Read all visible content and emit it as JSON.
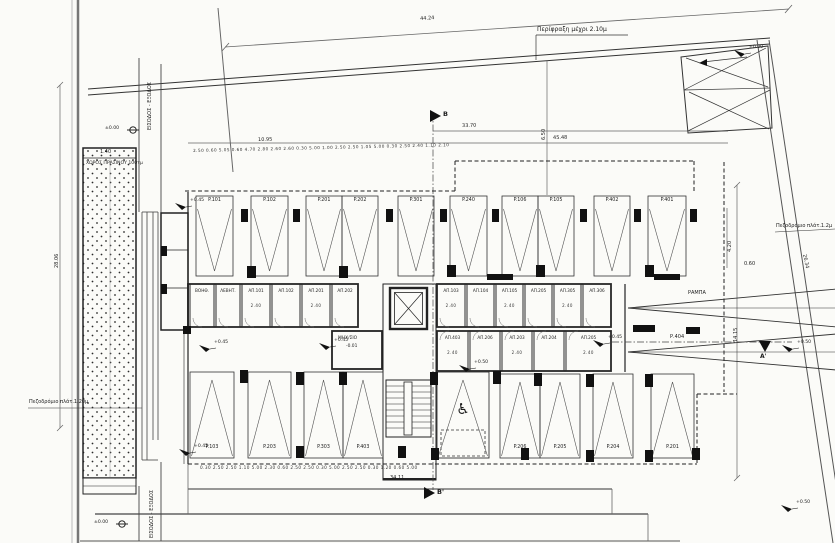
{
  "site": {
    "fence_label": "Περίφραξη μέχρι 2.10μ",
    "sidewalk_right_label": "Πεζοδρόμιο πλάτ.1.2μ",
    "sidewalk_left_label": "Πεζοδρόμιο πλάτ.1.20μ",
    "green_area_label": "ΧΩΡΟΣ ΠΡΑΣΙΝΟΥ 100τμ",
    "entry_top_label": "ΕΙΣΟΔΟΣ - ΕΞΟΔΟΣ",
    "entry_bottom_label": "ΕΙΣΟΔΟΣ - ΕΞΟΔΟΣ",
    "machine_room_label": "ΜΗΧ/ΣΙΟ",
    "machine_room_level": "-0.01",
    "ramp_label": "ΡΑΜΠΑ",
    "aisle_label": "Ρ.404",
    "section_b": "B",
    "section_b2": "B'",
    "section_a2": "A'"
  },
  "levels": [
    {
      "label": "±0.00",
      "x": 133,
      "y": 130,
      "kind": "bm"
    },
    {
      "label": "±0.00",
      "x": 122,
      "y": 524,
      "kind": "bm"
    },
    {
      "label": "+0.45",
      "x": 186,
      "y": 207,
      "kind": "flag"
    },
    {
      "label": "+0.45",
      "x": 210,
      "y": 349,
      "kind": "flag"
    },
    {
      "label": "+0.45",
      "x": 330,
      "y": 347,
      "kind": "flag"
    },
    {
      "label": "+0.50",
      "x": 470,
      "y": 369,
      "kind": "flag"
    },
    {
      "label": "+0.45",
      "x": 604,
      "y": 344,
      "kind": "flag"
    },
    {
      "label": "±0.00",
      "x": 745,
      "y": 54,
      "kind": "flag"
    },
    {
      "label": "+0.50",
      "x": 793,
      "y": 349,
      "kind": "flag"
    },
    {
      "label": "+0.50",
      "x": 792,
      "y": 509,
      "kind": "flag"
    },
    {
      "label": "+0.45",
      "x": 190,
      "y": 453,
      "kind": "flag"
    }
  ],
  "dimensions": [
    {
      "t": "44.24",
      "x": 420,
      "y": 17,
      "r": -3.7
    },
    {
      "t": "45.48",
      "x": 553,
      "y": 136,
      "r": -1
    },
    {
      "t": "10.95",
      "x": 258,
      "y": 138,
      "r": -1
    },
    {
      "t": "33.70",
      "x": 462,
      "y": 124,
      "r": -1
    },
    {
      "t": "6.50",
      "x": 542,
      "y": 140,
      "r": -90
    },
    {
      "t": "14.15",
      "x": 734,
      "y": 342,
      "r": -90
    },
    {
      "t": "4.20",
      "x": 728,
      "y": 252,
      "r": -90
    },
    {
      "t": "0.60",
      "x": 744,
      "y": 262,
      "r": 0
    },
    {
      "t": "26.34",
      "x": 806,
      "y": 254,
      "r": 78
    },
    {
      "t": "28.06",
      "x": 55,
      "y": 268,
      "r": -90
    },
    {
      "t": "34.11",
      "x": 390,
      "y": 476,
      "r": 0
    },
    {
      "t": "1.40",
      "x": 100,
      "y": 150,
      "r": 0
    },
    {
      "t": "2.50 0.60 5.05 0.60 4.70 2.80 2.60 2.60 0.30 5.00 1.00 2.50 2.50 1.05 5.00 0.30 2.50 2.40 1.10 2.10",
      "x": 193,
      "y": 149,
      "r": -1.3,
      "cls": "chain"
    },
    {
      "t": "0.30 2.50 2.50 1.10 5.00 2.30 0.60 2.50 2.50 0.30 5.00 2.50 2.50 0.30 1.20 0.60 5.00",
      "x": 200,
      "y": 466,
      "r": 0,
      "cls": "chain"
    }
  ],
  "parking": {
    "rows": [
      {
        "id": "top-row",
        "y": 196,
        "h": 80,
        "apex": "down",
        "stalls": [
          {
            "label": "P.101",
            "x": 196,
            "w": 37
          },
          {
            "label": "P.102",
            "x": 251,
            "w": 37
          },
          {
            "label": "P.201",
            "x": 306,
            "w": 36
          },
          {
            "label": "P.202",
            "x": 342,
            "w": 36
          },
          {
            "label": "P.301",
            "x": 398,
            "w": 36
          },
          {
            "label": "P.240",
            "x": 450,
            "w": 37
          },
          {
            "label": "P.106",
            "x": 502,
            "w": 36
          },
          {
            "label": "P.105",
            "x": 538,
            "w": 36
          },
          {
            "label": "P.402",
            "x": 594,
            "w": 36
          },
          {
            "label": "P.401",
            "x": 648,
            "w": 38
          }
        ]
      },
      {
        "id": "bottom-left-row",
        "y": 372,
        "h": 86,
        "apex": "up",
        "stalls": [
          {
            "label": "P.103",
            "x": 190,
            "w": 44
          },
          {
            "label": "P.203",
            "x": 248,
            "w": 43
          },
          {
            "label": "P.303",
            "x": 304,
            "w": 39
          },
          {
            "label": "P.403",
            "x": 343,
            "w": 40
          }
        ]
      },
      {
        "id": "bottom-right-row",
        "y": 374,
        "h": 84,
        "apex": "up",
        "stalls": [
          {
            "label": "P.206",
            "x": 500,
            "w": 40
          },
          {
            "label": "P.205",
            "x": 540,
            "w": 40
          },
          {
            "label": "P.204",
            "x": 593,
            "w": 40
          },
          {
            "label": "P.201",
            "x": 651,
            "w": 43
          }
        ]
      }
    ],
    "accessible": {
      "x": 437,
      "y": 372,
      "w": 52,
      "h": 86,
      "icon": "♿"
    }
  },
  "rooms": {
    "bands": [
      {
        "id": "storage-top-left",
        "y": 284,
        "h": 43,
        "door": "bottom",
        "items": [
          {
            "label": "ΒΟΗΘ.",
            "x": 190,
            "w": 24
          },
          {
            "label": "ΛΕΒΗΤ.",
            "x": 216,
            "w": 24
          },
          {
            "label": "ΑΠ.101",
            "x": 242,
            "w": 28,
            "dim": "2.40"
          },
          {
            "label": "ΑΠ.102",
            "x": 272,
            "w": 28
          },
          {
            "label": "ΑΠ.201",
            "x": 302,
            "w": 28,
            "dim": "2.40"
          },
          {
            "label": "ΑΠ.202",
            "x": 332,
            "w": 26
          }
        ]
      },
      {
        "id": "storage-top-right",
        "y": 284,
        "h": 43,
        "door": "bottom",
        "items": [
          {
            "label": "ΑΠ.103",
            "x": 437,
            "w": 28,
            "dim": "2.40"
          },
          {
            "label": "ΑΠ.104",
            "x": 467,
            "w": 27
          },
          {
            "label": "ΑΠ.105",
            "x": 496,
            "w": 27,
            "dim": "2.40"
          },
          {
            "label": "ΑΠ.205",
            "x": 525,
            "w": 27
          },
          {
            "label": "ΑΠ.305",
            "x": 554,
            "w": 27,
            "dim": "2.40"
          },
          {
            "label": "ΑΠ.306",
            "x": 583,
            "w": 28
          }
        ]
      },
      {
        "id": "storage-bottom-right",
        "y": 331,
        "h": 40,
        "door": "top",
        "items": [
          {
            "label": "ΑΠ.403",
            "x": 437,
            "w": 31,
            "dim": "2.40"
          },
          {
            "label": "ΑΠ.206",
            "x": 470,
            "w": 30
          },
          {
            "label": "ΑΠ.203",
            "x": 502,
            "w": 30,
            "dim": "2.40"
          },
          {
            "label": "ΑΠ.204",
            "x": 534,
            "w": 30
          },
          {
            "label": "ΑΠ.205",
            "x": 566,
            "w": 45,
            "dim": "2.40"
          }
        ]
      }
    ]
  },
  "pillars": [
    [
      241,
      209,
      7,
      13
    ],
    [
      293,
      209,
      7,
      13
    ],
    [
      386,
      209,
      7,
      13
    ],
    [
      440,
      209,
      7,
      13
    ],
    [
      492,
      209,
      7,
      13
    ],
    [
      580,
      209,
      7,
      13
    ],
    [
      634,
      209,
      7,
      13
    ],
    [
      690,
      209,
      7,
      13
    ],
    [
      247,
      266,
      9,
      12
    ],
    [
      339,
      266,
      9,
      12
    ],
    [
      447,
      265,
      9,
      12
    ],
    [
      536,
      265,
      9,
      12
    ],
    [
      645,
      265,
      9,
      12
    ],
    [
      487,
      274,
      26,
      6
    ],
    [
      654,
      274,
      26,
      6
    ],
    [
      633,
      325,
      22,
      7
    ],
    [
      686,
      327,
      14,
      7
    ],
    [
      240,
      370,
      8,
      13
    ],
    [
      296,
      372,
      8,
      13
    ],
    [
      339,
      372,
      8,
      13
    ],
    [
      430,
      372,
      8,
      13
    ],
    [
      493,
      371,
      8,
      13
    ],
    [
      534,
      373,
      8,
      13
    ],
    [
      586,
      374,
      8,
      13
    ],
    [
      645,
      374,
      8,
      13
    ],
    [
      296,
      446,
      8,
      12
    ],
    [
      398,
      446,
      8,
      12
    ],
    [
      431,
      448,
      8,
      12
    ],
    [
      521,
      448,
      8,
      12
    ],
    [
      586,
      450,
      8,
      12
    ],
    [
      645,
      450,
      8,
      12
    ],
    [
      692,
      448,
      8,
      12
    ],
    [
      161,
      246,
      6,
      10
    ],
    [
      161,
      284,
      6,
      10
    ],
    [
      183,
      326,
      8,
      8
    ]
  ]
}
